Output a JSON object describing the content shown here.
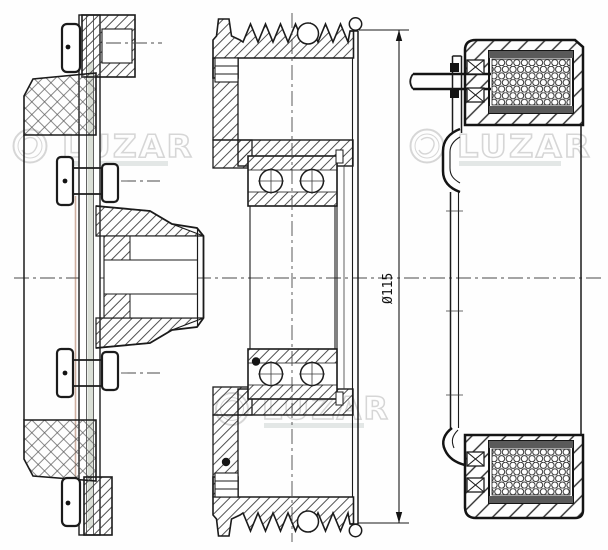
{
  "drawing": {
    "dimension_label": "Ø115",
    "watermark_text": "LUZAR",
    "colors": {
      "line": "#1b1b1b",
      "watermark": "#b0b0b0",
      "liner_accent_green": "#b6bfae",
      "liner_accent_brown": "#96512f",
      "background": "#ffffff"
    }
  }
}
